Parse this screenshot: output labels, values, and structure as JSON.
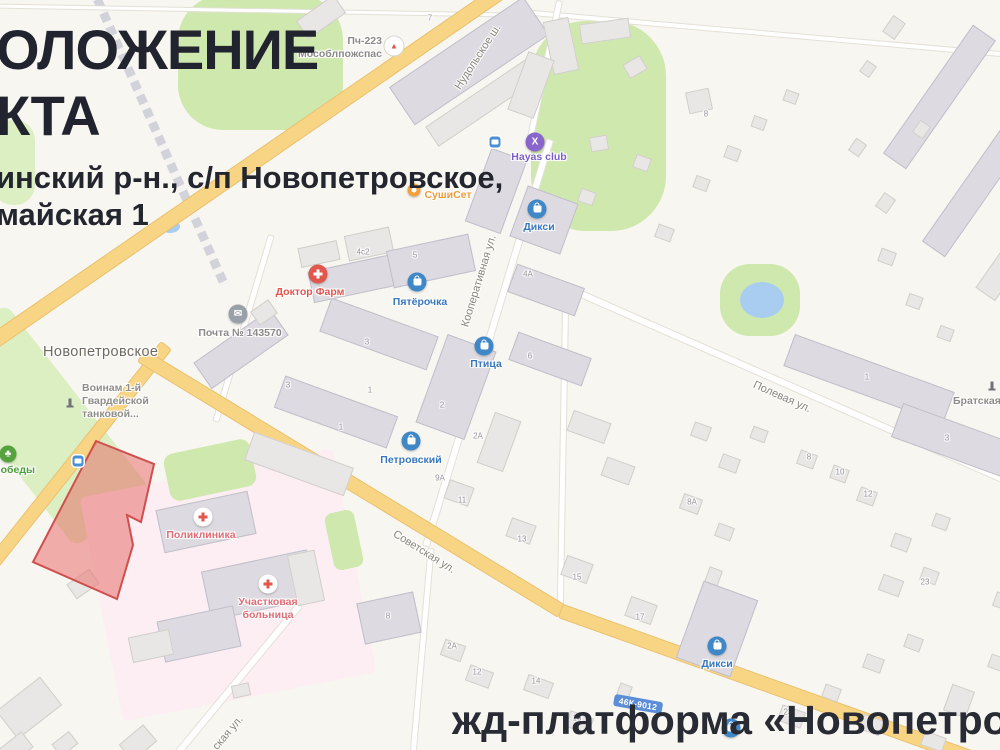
{
  "overlay": {
    "title_line1": "ОЛОЖЕНИЕ",
    "title_line2": "КТА",
    "address_line1": "инский р-н., с/п Новопетровское,",
    "address_line2": "майская 1",
    "bottom_caption": "жд-платформа «Новопетровская"
  },
  "map": {
    "settlement": {
      "label": "Новопетровское",
      "x": 43,
      "y": 344
    },
    "road_badge": {
      "text": "46К-9012",
      "x": 638,
      "y": 704
    },
    "road_labels": [
      {
        "text": "Нудольское ш.",
        "x": 478,
        "y": 57,
        "rot": -57
      },
      {
        "text": "Кооперативная ул.",
        "x": 479,
        "y": 281,
        "rot": -73
      },
      {
        "text": "Полевая ул.",
        "x": 782,
        "y": 397,
        "rot": 24
      },
      {
        "text": "Советская ул.",
        "x": 424,
        "y": 552,
        "rot": 32
      },
      {
        "text": "ская ул.",
        "x": 228,
        "y": 733,
        "rot": -50
      }
    ],
    "areas": [
      [
        "green",
        260,
        62,
        165,
        135,
        0,
        45
      ],
      [
        "green",
        598,
        126,
        135,
        210,
        0,
        55
      ],
      [
        "green2",
        14,
        162,
        42,
        85,
        0,
        20
      ],
      [
        "green2",
        40,
        425,
        95,
        235,
        -38,
        10
      ],
      [
        "pink",
        228,
        585,
        258,
        228,
        -11,
        6
      ],
      [
        "green",
        210,
        470,
        88,
        48,
        -12,
        10
      ],
      [
        "green",
        344,
        540,
        30,
        58,
        -12,
        8
      ],
      [
        "green",
        760,
        300,
        80,
        72,
        0,
        30
      ],
      [
        "water",
        762,
        300,
        44,
        36,
        0,
        0
      ],
      [
        "water",
        170,
        226,
        20,
        13,
        0,
        0
      ]
    ],
    "roads": [
      [
        "rail",
        158,
        135,
        328,
        66,
        9
      ],
      [
        "minor",
        250,
        9,
        520,
        1,
        3
      ],
      [
        "minor",
        760,
        32,
        480,
        5,
        4
      ],
      [
        "minor",
        543,
        70,
        143,
        102,
        5
      ],
      [
        "minor",
        487,
        342,
        424,
        107,
        6
      ],
      [
        "minor",
        242,
        327,
        193,
        106.6,
        5
      ],
      [
        "minor",
        785,
        383,
        480,
        23.7,
        6
      ],
      [
        "minor",
        562,
        450,
        320,
        91,
        5
      ],
      [
        "minor",
        234,
        682,
        201,
        -50.5,
        6
      ],
      [
        "minor",
        421,
        651,
        208,
        95,
        5
      ],
      [
        "major",
        247,
        165,
        650,
        -34.6,
        14
      ],
      [
        "major",
        77,
        455,
        281,
        -51.5,
        12
      ],
      [
        "major",
        350,
        482,
        491,
        31.3,
        13
      ],
      [
        "major",
        790,
        692,
        489,
        19.7,
        13
      ]
    ],
    "object_polygon": "96,441 154,464 141,522 127,515 133,545 117,599 33,562",
    "object_colors": {
      "fill": "rgba(232,112,108,0.55)",
      "stroke": "#cf4f4f"
    },
    "buildings": [
      [
        320,
        16,
        44,
        20,
        -35,
        0
      ],
      [
        468,
        60,
        160,
        44,
        -34,
        1
      ],
      [
        484,
        100,
        126,
        22,
        -34,
        0
      ],
      [
        560,
        45,
        24,
        52,
        -12,
        0
      ],
      [
        604,
        30,
        48,
        18,
        -8,
        0
      ],
      [
        634,
        66,
        18,
        14,
        -30,
        0
      ],
      [
        530,
        84,
        26,
        60,
        20,
        0
      ],
      [
        698,
        100,
        22,
        20,
        -12,
        0
      ],
      [
        893,
        26,
        18,
        13,
        -55,
        0
      ],
      [
        938,
        96,
        155,
        26,
        -55,
        1
      ],
      [
        976,
        186,
        150,
        26,
        -55,
        1
      ],
      [
        920,
        128,
        13,
        11,
        -55,
        0
      ],
      [
        884,
        202,
        15,
        12,
        -55,
        0
      ],
      [
        1002,
        268,
        60,
        22,
        -55,
        0
      ],
      [
        598,
        142,
        16,
        13,
        -10,
        0
      ],
      [
        586,
        196,
        14,
        12,
        20,
        0
      ],
      [
        641,
        162,
        14,
        12,
        20,
        0
      ],
      [
        663,
        232,
        15,
        12,
        20,
        0
      ],
      [
        700,
        182,
        13,
        11,
        20,
        0
      ],
      [
        731,
        152,
        13,
        11,
        20,
        0
      ],
      [
        758,
        122,
        12,
        10,
        20,
        0
      ],
      [
        790,
        96,
        12,
        10,
        20,
        0
      ],
      [
        856,
        146,
        13,
        11,
        -55,
        0
      ],
      [
        886,
        256,
        14,
        12,
        20,
        0
      ],
      [
        913,
        300,
        13,
        11,
        20,
        0
      ],
      [
        944,
        332,
        13,
        11,
        20,
        0
      ],
      [
        867,
        68,
        12,
        10,
        -55,
        0
      ],
      [
        495,
        190,
        36,
        76,
        20,
        1
      ],
      [
        543,
        219,
        52,
        52,
        20,
        1
      ],
      [
        368,
        243,
        44,
        24,
        -12,
        0
      ],
      [
        430,
        260,
        82,
        36,
        -12,
        1
      ],
      [
        350,
        278,
        80,
        30,
        -12,
        1
      ],
      [
        318,
        253,
        38,
        18,
        -12,
        0
      ],
      [
        240,
        348,
        92,
        30,
        -35,
        1
      ],
      [
        263,
        311,
        20,
        15,
        -35,
        0
      ],
      [
        378,
        333,
        112,
        34,
        20,
        1
      ],
      [
        335,
        411,
        118,
        32,
        20,
        1
      ],
      [
        298,
        463,
        104,
        28,
        20,
        0
      ],
      [
        455,
        386,
        50,
        92,
        20,
        1
      ],
      [
        498,
        441,
        26,
        52,
        20,
        0
      ],
      [
        545,
        289,
        70,
        28,
        20,
        1
      ],
      [
        549,
        358,
        76,
        28,
        20,
        1
      ],
      [
        588,
        426,
        38,
        20,
        20,
        0
      ],
      [
        617,
        470,
        28,
        18,
        20,
        0
      ],
      [
        868,
        378,
        168,
        32,
        20,
        1
      ],
      [
        976,
        448,
        168,
        34,
        20,
        1
      ],
      [
        700,
        430,
        16,
        13,
        20,
        0
      ],
      [
        728,
        462,
        17,
        13,
        20,
        0
      ],
      [
        758,
        433,
        14,
        11,
        20,
        0
      ],
      [
        806,
        458,
        16,
        13,
        20,
        0
      ],
      [
        838,
        473,
        15,
        12,
        20,
        0
      ],
      [
        866,
        495,
        16,
        13,
        20,
        0
      ],
      [
        690,
        503,
        18,
        14,
        20,
        0
      ],
      [
        723,
        531,
        15,
        12,
        20,
        0
      ],
      [
        900,
        541,
        16,
        13,
        20,
        0
      ],
      [
        940,
        521,
        14,
        12,
        20,
        0
      ],
      [
        458,
        492,
        24,
        18,
        20,
        0
      ],
      [
        520,
        530,
        24,
        18,
        20,
        0
      ],
      [
        576,
        568,
        26,
        19,
        20,
        0
      ],
      [
        640,
        609,
        26,
        19,
        20,
        0
      ],
      [
        712,
        577,
        12,
        18,
        20,
        0
      ],
      [
        890,
        584,
        20,
        15,
        20,
        0
      ],
      [
        928,
        575,
        15,
        12,
        20,
        0
      ],
      [
        388,
        617,
        56,
        40,
        -12,
        1
      ],
      [
        452,
        649,
        20,
        15,
        20,
        0
      ],
      [
        478,
        675,
        23,
        15,
        20,
        0
      ],
      [
        537,
        685,
        25,
        15,
        20,
        0
      ],
      [
        578,
        721,
        23,
        15,
        20,
        0
      ],
      [
        622,
        692,
        11,
        17,
        20,
        0
      ],
      [
        716,
        628,
        56,
        80,
        20,
        1
      ],
      [
        790,
        715,
        23,
        15,
        20,
        0
      ],
      [
        830,
        692,
        15,
        12,
        20,
        0
      ],
      [
        872,
        662,
        17,
        13,
        20,
        0
      ],
      [
        912,
        642,
        15,
        12,
        20,
        0
      ],
      [
        958,
        700,
        22,
        26,
        20,
        0
      ],
      [
        996,
        662,
        15,
        12,
        20,
        0
      ],
      [
        870,
        724,
        19,
        14,
        20,
        0
      ],
      [
        932,
        740,
        21,
        13,
        20,
        0
      ],
      [
        1002,
        600,
        16,
        13,
        20,
        0
      ],
      [
        205,
        521,
        92,
        42,
        -12,
        1
      ],
      [
        258,
        584,
        106,
        48,
        -12,
        1
      ],
      [
        198,
        633,
        76,
        40,
        -12,
        1
      ],
      [
        150,
        645,
        40,
        24,
        -12,
        0
      ],
      [
        240,
        689,
        16,
        11,
        -12,
        0
      ],
      [
        305,
        577,
        26,
        50,
        -12,
        0
      ],
      [
        82,
        583,
        26,
        16,
        -35,
        0
      ],
      [
        28,
        707,
        54,
        34,
        -38,
        0
      ],
      [
        14,
        748,
        30,
        18,
        -38,
        0
      ],
      [
        64,
        743,
        20,
        14,
        -38,
        0
      ],
      [
        137,
        742,
        30,
        20,
        -40,
        0
      ]
    ],
    "house_numbers": [
      [
        430,
        18,
        "7"
      ],
      [
        706,
        114,
        "8"
      ],
      [
        363,
        252,
        "4с2"
      ],
      [
        415,
        255,
        "5"
      ],
      [
        528,
        274,
        "4А"
      ],
      [
        367,
        342,
        "3"
      ],
      [
        530,
        356,
        "6"
      ],
      [
        288,
        385,
        "3"
      ],
      [
        370,
        390,
        "1"
      ],
      [
        442,
        405,
        "2"
      ],
      [
        341,
        427,
        "1"
      ],
      [
        478,
        436,
        "2А"
      ],
      [
        440,
        478,
        "9А"
      ],
      [
        462,
        500,
        "11"
      ],
      [
        867,
        377,
        "1"
      ],
      [
        947,
        438,
        "3"
      ],
      [
        809,
        457,
        "8"
      ],
      [
        840,
        472,
        "10"
      ],
      [
        868,
        494,
        "12"
      ],
      [
        692,
        502,
        "8А"
      ],
      [
        522,
        539,
        "13"
      ],
      [
        577,
        577,
        "15"
      ],
      [
        640,
        617,
        "17"
      ],
      [
        925,
        582,
        "23"
      ],
      [
        388,
        616,
        "8"
      ],
      [
        452,
        646,
        "2А"
      ],
      [
        477,
        672,
        "12"
      ],
      [
        536,
        681,
        "14"
      ],
      [
        577,
        718,
        "16"
      ],
      [
        788,
        712,
        "23"
      ]
    ],
    "bus_stops": [
      [
        495,
        142
      ],
      [
        78,
        461
      ]
    ],
    "pois": [
      {
        "n": "fire-station",
        "t": "fire",
        "x": 394,
        "y": 46,
        "lines": [
          "Пч-223",
          "Мособлпожспас"
        ],
        "lx": 382,
        "ly": 35,
        "anchor": "r",
        "color": "#8c8a88"
      },
      {
        "n": "hayas-club",
        "t": "club",
        "x": 535,
        "y": 142,
        "lines": [
          "Hayas club"
        ],
        "lx": 539,
        "ly": 151,
        "anchor": "c",
        "color": "#7a5fc6"
      },
      {
        "n": "sushiset",
        "t": "food",
        "x": 414,
        "y": 190,
        "lines": [
          "СушиСет"
        ],
        "lx": 448,
        "ly": 189,
        "anchor": "c",
        "color": "#ef9b3a"
      },
      {
        "n": "dixy-north",
        "t": "shop",
        "x": 537,
        "y": 209,
        "lines": [
          "Дикси"
        ],
        "lx": 539,
        "ly": 221,
        "anchor": "c",
        "color": "#3877bc"
      },
      {
        "n": "pyaterochka",
        "t": "shop",
        "x": 417,
        "y": 282,
        "lines": [
          "Пятёрочка"
        ],
        "lx": 420,
        "ly": 296,
        "anchor": "c",
        "color": "#3877bc"
      },
      {
        "n": "doktor-farm",
        "t": "pharmacy",
        "x": 318,
        "y": 274,
        "lines": [
          "Доктор Фарм"
        ],
        "lx": 310,
        "ly": 286,
        "anchor": "c",
        "color": "#e0554e"
      },
      {
        "n": "post-office",
        "t": "post",
        "x": 238,
        "y": 314,
        "lines": [
          "Почта № 143570"
        ],
        "lx": 240,
        "ly": 327,
        "anchor": "c",
        "color": "#8c8a88"
      },
      {
        "n": "ptitsa",
        "t": "shop",
        "x": 484,
        "y": 346,
        "lines": [
          "Птица"
        ],
        "lx": 486,
        "ly": 358,
        "anchor": "c",
        "color": "#3877bc"
      },
      {
        "n": "petrovskiy",
        "t": "shop",
        "x": 411,
        "y": 441,
        "lines": [
          "Петровский"
        ],
        "lx": 411,
        "ly": 454,
        "anchor": "c",
        "color": "#3877bc"
      },
      {
        "n": "poliklinika",
        "t": "medical",
        "x": 203,
        "y": 517,
        "lines": [
          "Поликлиника"
        ],
        "lx": 201,
        "ly": 529,
        "anchor": "c",
        "color": "#df6d76"
      },
      {
        "n": "uchastkovaya-bolnitsa",
        "t": "medical",
        "x": 268,
        "y": 584,
        "lines": [
          "Участковая",
          "больница"
        ],
        "lx": 268,
        "ly": 596,
        "anchor": "c",
        "color": "#df6d76"
      },
      {
        "n": "dixy-south",
        "t": "shop",
        "x": 717,
        "y": 646,
        "lines": [
          "Дикси"
        ],
        "lx": 717,
        "ly": 658,
        "anchor": "c",
        "color": "#3877bc"
      },
      {
        "n": "pobedy-park",
        "t": "park",
        "x": 8,
        "y": 454,
        "lines": [
          "Победы"
        ],
        "lx": 14,
        "ly": 464,
        "anchor": "c",
        "color": "#4e9e3d"
      },
      {
        "n": "voinam-memorial",
        "t": "monument",
        "x": 70,
        "y": 402,
        "lines": [
          "Воинам 1-й",
          "Гвардейской",
          "танковой..."
        ],
        "lx": 82,
        "ly": 382,
        "anchor": "l",
        "color": "#8f8d8a"
      },
      {
        "n": "bratskaya-memorial",
        "t": "monument",
        "x": 992,
        "y": 385,
        "lines": [
          "Братская"
        ],
        "lx": 953,
        "ly": 395,
        "anchor": "l",
        "color": "#8f8d8a"
      },
      {
        "n": "platform-poi",
        "t": "shop",
        "x": 731,
        "y": 728,
        "lines": [],
        "lx": 0,
        "ly": 0,
        "anchor": "c",
        "color": "#3877bc"
      }
    ]
  }
}
